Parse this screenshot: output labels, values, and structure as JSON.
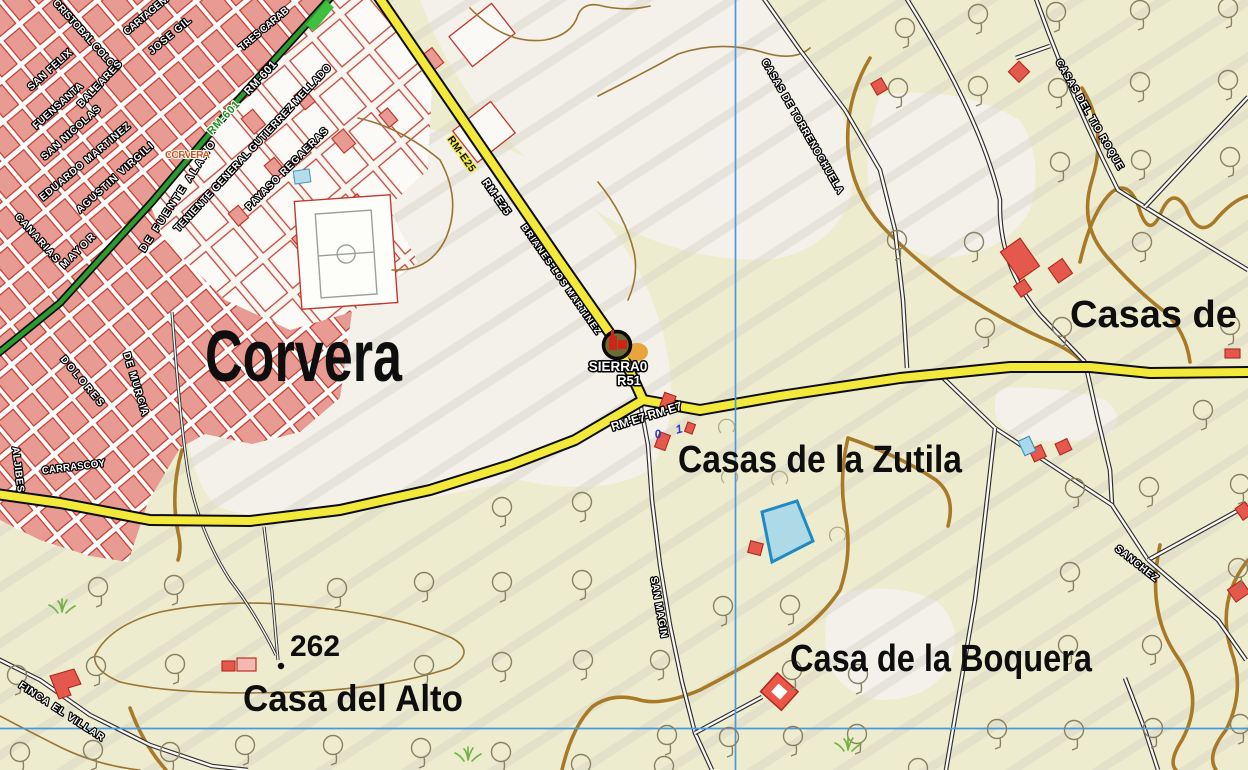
{
  "colors": {
    "background": "#eeeccf",
    "field_white": "#f3f1ea",
    "urban_fill": "#e89b92",
    "urban_outline": "#c0392b",
    "road_primary_yellow": "#f3e93a",
    "road_secondary_green": "#2d9a2d",
    "track_white": "#fbfaf6",
    "contour_brown": "#a87a28",
    "grid_blue": "#459ae0",
    "water_blue": "#aed9e6",
    "marker_ring": "#0a0a0a"
  },
  "settlements": {
    "corvera": {
      "text": "Corvera"
    },
    "zutila": {
      "text": "Casas de la Zutila"
    },
    "boquera": {
      "text": "Casa de la Boquera"
    },
    "alto": {
      "text": "Casa del  Alto"
    },
    "casas_p": {
      "text": "Casas de Pi"
    },
    "corvera_small": {
      "text": "CORVERA"
    }
  },
  "streets": [
    {
      "name": "CARTAGENA"
    },
    {
      "name": "CRISTOBAL COLON"
    },
    {
      "name": "JOSE GIL"
    },
    {
      "name": "TRES CARAB"
    },
    {
      "name": "SAN FELIX"
    },
    {
      "name": "FUENSANTA"
    },
    {
      "name": "BALEARES"
    },
    {
      "name": "SAN NICOLAS"
    },
    {
      "name": "EDUARDO MARTINEZ"
    },
    {
      "name": "AGUSTIN VIRGILI"
    },
    {
      "name": "DE FUENTE ALAMO"
    },
    {
      "name": "TENIENTE GENERAL GUTIERREZ MELLADO"
    },
    {
      "name": "PAYASO REGAERAS"
    },
    {
      "name": "CANARIAS"
    },
    {
      "name": "MAYOR"
    },
    {
      "name": "DOLORES"
    },
    {
      "name": "DE MURCIA"
    },
    {
      "name": "ALJIBES"
    },
    {
      "name": "CARRASCOY"
    },
    {
      "name": "FINCA EL VILLAR"
    },
    {
      "name": "SAN MAGIN"
    },
    {
      "name": "SANCHEZ"
    },
    {
      "name": "CASAS DE TORRENOCHUELA"
    },
    {
      "name": "CASAS DEL TIO ROQUE"
    }
  ],
  "roads": {
    "rm601_green": "RM-601",
    "rm601_black": "RM-601",
    "rme25_a": "RM-E25",
    "rme25_b": "RM-E25",
    "brianes": "BRIANES-LOS MARTINEZ",
    "rme7": "RM-E7-RM-E7"
  },
  "marker": {
    "title": "SIERRA0",
    "code": "R51"
  },
  "elevation": {
    "value": "262"
  },
  "km_markers": [
    "0",
    "1"
  ]
}
